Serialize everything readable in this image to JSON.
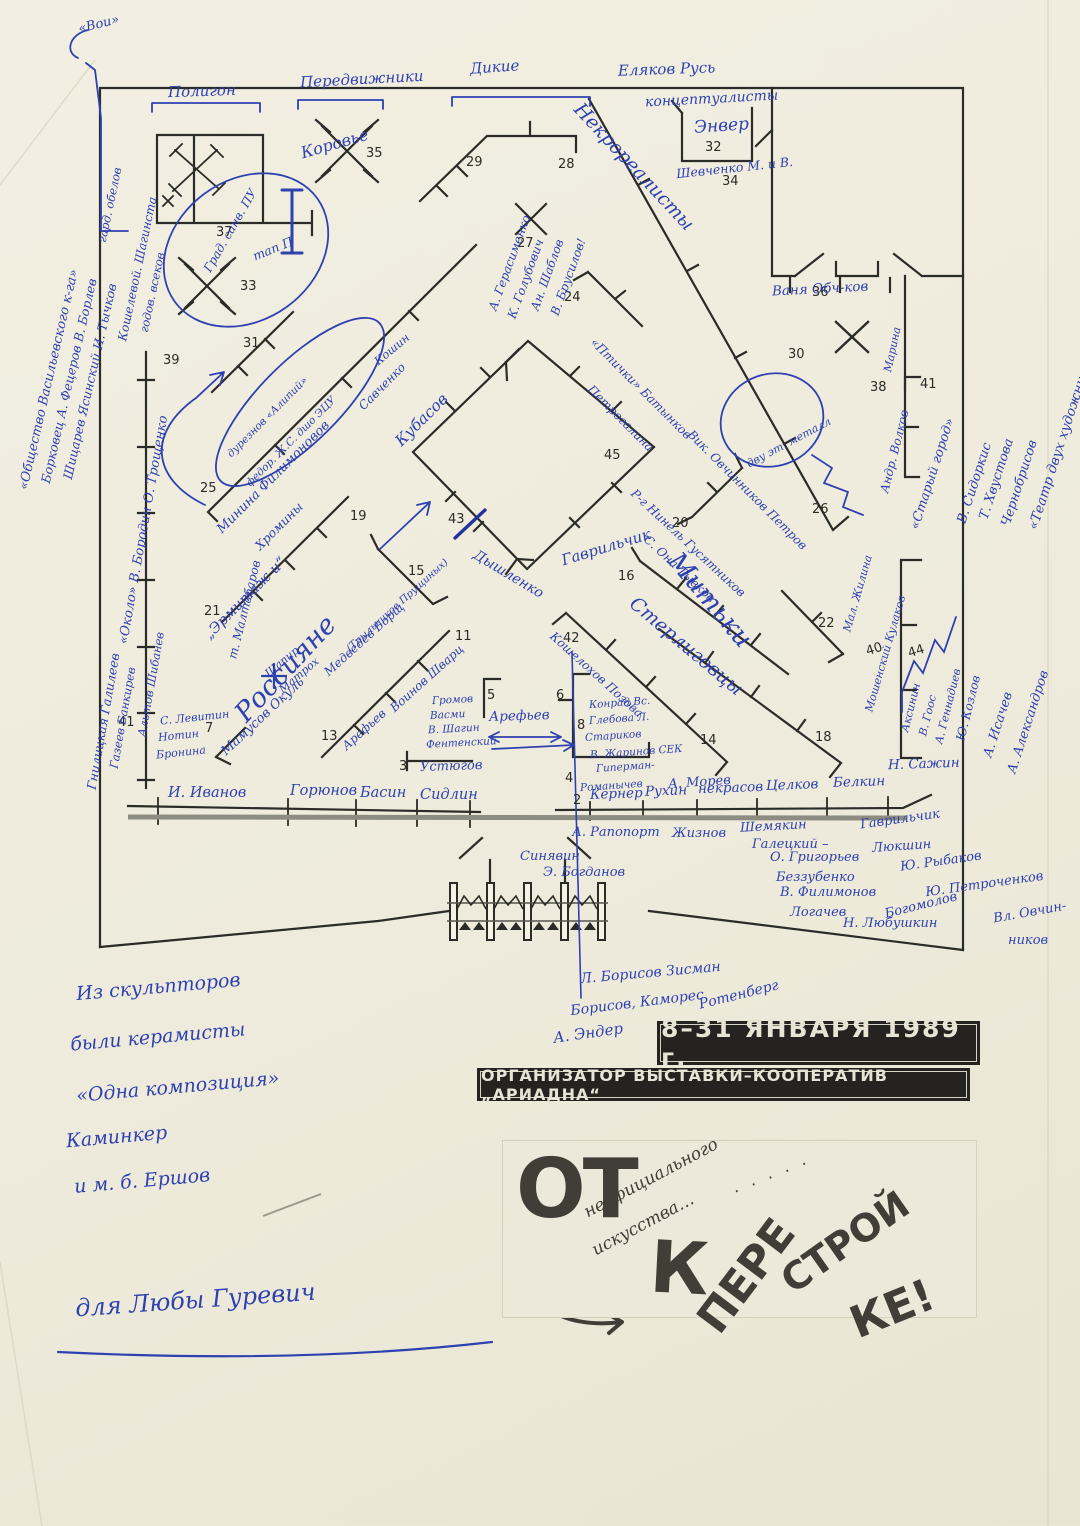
{
  "t": {
    "poligon": "Полигон",
    "peredvizhniki": "Передвижники",
    "dikie": "Дикие",
    "elakov": "Еляков Русь",
    "koncept": "концептуалисты",
    "voi": "«Вои»",
    "oval1a": "Град. санв. ПУ",
    "oval1b": "тап П",
    "korovye": "Коровье",
    "nekro": "Некрореалисты",
    "enver": "Энвер",
    "shevchenko": "Шевченко М. и В.",
    "vanya": "Ваня Обч-ков",
    "marina": "Марина",
    "stargorod": "«Старый город»",
    "volkov": "Андр. Волков",
    "ovaltxt": "дву эт. металл",
    "gerasimenko": "А. Герасименко",
    "golubovich": "К. Голубович",
    "shablov": "Ан. Шаблов",
    "brusilov": "В. Брусилов!",
    "ptichki": "«Птички» Батынков",
    "petrogalina": "Петрогалина",
    "vikovch": "Вик. Овчинников Петров",
    "ninel": "Р-г Нинель Гусятников",
    "onatyv": "С. Она-Тывков",
    "minina": "Минина Филимоновов",
    "hromin": "Хромины",
    "savchenko": "Савченко",
    "koshin": "Кошин",
    "alipiy": "дурезнов «Алипий»",
    "fedor": "федор. Ж.С. дшо ЭЦУ",
    "ermitazh": "„Эрмитаж и“",
    "ross": "Россияне",
    "kubasov": "Кубасов",
    "gavrilchik": "Гаврильчик",
    "dyshlenko": "Дышленко",
    "mitki": "Митьки",
    "sterligovcy": "Стерлиговцы",
    "koshelohov": "Кошелохов Позова",
    "shapir": "Шапир",
    "matroh": "Матрох",
    "levitin": "С. Левитин",
    "notin": "Нотин",
    "bronina": "Бронина",
    "mamusov": "Мамусов Окуль",
    "medvedev": "Медведев Борщ",
    "trylnikov": "(Трыльников Прущиных)",
    "voinov": "Воинов Шварц",
    "arefievD": "Арефьев",
    "arefievH": "Арефьев",
    "gromov": "Громов",
    "vasmi": "Васми",
    "vshagin": "В. Шагин",
    "fentenskiy": "Фентенский",
    "ustyugov": "Устюгов",
    "konrad": "Конрад Вс.",
    "glebova": "Глебова Л.",
    "starikov": "Стариков",
    "zharinov": "В. Жаринов СЕК",
    "giperman": "Гиперман-",
    "romanychev": "Романычев",
    "morev": "А. Морев",
    "ivanov": "И. Иванов",
    "goryunov": "Горюнов",
    "basin": "Басин",
    "sidlin": "Сидлин",
    "kerner": "Кернер",
    "ruhin": "Рухин",
    "nekrasov": "некрасов",
    "celkov": "Целков",
    "belkin": "Белкин",
    "rapoport": "А. Рапопорт",
    "zhiznov": "Жизнов",
    "shemyakin": "Шемякин",
    "sinyavin": "Синявин",
    "galeckiy": "Галецкий –",
    "gavrilchik2": "Гаврильчик",
    "bogdanov": "Э. Богданов",
    "grigoriev": "О. Григорьев",
    "lyukshin": "Люкшин",
    "bezzubenko": "Беззубенко",
    "rybakov": "Ю. Рыбаков",
    "filimonov": "В. Филимонов",
    "petrochenkov": "Ю. Петроченков",
    "logachev": "Логачев",
    "bogomolov": "Богомолов",
    "lyubushkin": "Н. Любушкин",
    "ovchin": "Вл. Овчин-",
    "nikov": "ников",
    "borisov1": "Л. Борисов Зисман",
    "borisov2": "Борисов, Каморес",
    "rotenberg": "Ротенберг",
    "ender": "А. Эндер",
    "sazhin": "Н. Сажин",
    "zhilina": "Мал. Жилина",
    "kulakov": "Мошенский Кулаков",
    "aksinin": "Аксинин",
    "goos": "В. Гоос",
    "gennadiev": "А. Геннадиев",
    "kozlov": "Ю. Козлов",
    "isachev": "А. Исачев",
    "aleksandrov": "А. Александров",
    "sidorkis": "В. Сидоркис",
    "hvustova": "Т. Хвустова",
    "chernobrisov": "Чернобрисов",
    "teatr": "«Театр двух художник»",
    "obshestvo": "«Общество Васильевского к-га»",
    "borkovec": "Борковец А. Фецеров В. Борлев",
    "shicarev": "Шицарев Ясинский И. Тычков",
    "koshelevoy": "Кошелевой. Шагинста",
    "godov": "годов. всеков",
    "garderob": "гард. обелов",
    "okolo": "«Около» В. Бородин О. Трощенко",
    "gnilickaya": "Гнилицкая Галилеев",
    "altov": "Альтов Шибанев",
    "gazeev": "Газеев Банкирев",
    "maltabarov": "т. Малтабаров",
    "note1": "Из скульпторов",
    "note2": "были керамисты",
    "note3": "«Одна композиция»",
    "note4": "Каминкер",
    "note5": "и м. б. Ершов",
    "dedication": "для Любы Гуревич",
    "n37": "37",
    "n33": "33",
    "n35": "35",
    "n29": "29",
    "n27": "27",
    "n28": "28",
    "n32": "32",
    "n34": "34",
    "n36": "36",
    "n30": "30",
    "n38": "38",
    "n41a": "41",
    "n24": "24",
    "n26": "26",
    "n31": "31",
    "n25": "25",
    "n39": "39",
    "n21": "21",
    "n19": "19",
    "n15": "15",
    "n43": "43",
    "n45": "45",
    "n20": "20",
    "n16": "16",
    "n22": "22",
    "n18": "18",
    "n42": "42",
    "n14": "14",
    "n44": "44",
    "n40": "40",
    "n5": "5",
    "n6": "6",
    "n8": "8",
    "n2": "2",
    "n3": "3",
    "n4": "4",
    "n7": "7",
    "n13": "13",
    "n11": "11",
    "n41b": "41"
  },
  "banners": {
    "dates": "8–31 ЯНВАРЯ 1989 г.",
    "organizer": "ОРГАНИЗАТОР ВЫСТАВКИ–КООПЕРАТИВ „АРИАДНА“"
  },
  "logo": {
    "from": "ОТ",
    "script1": "неофициального",
    "script2": "искусства…",
    "dots": "· · · · ·",
    "to": "К",
    "pere": "ПЕРЕ",
    "stroy": "СТРОЙ",
    "ke": "КЕ!"
  },
  "colors": {
    "ink_blue": "#2e41b0",
    "plan_black": "#2b2b27",
    "paper": "#efecdd",
    "banner_black": "#242320"
  }
}
